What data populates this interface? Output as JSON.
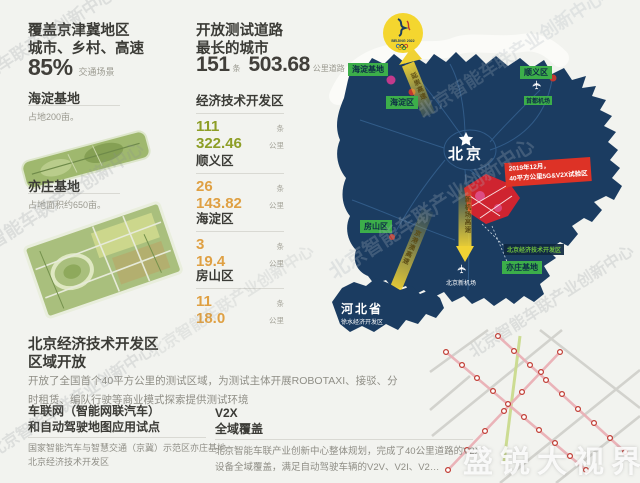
{
  "colors": {
    "accent_green": "#8d9e26",
    "accent_amber": "#dfa043",
    "label_green": "#3cae4a",
    "map_navy": "#1b3c61",
    "callout_red": "#dd3226",
    "arrow_yellow": "#f0d234"
  },
  "watermarks": {
    "diagonal": "北京智能车联产业创新中心",
    "video": "盛锐大视界"
  },
  "coverage": {
    "title_line1": "覆盖京津冀地区",
    "title_line2": "城市、乡村、高速",
    "percent": "85%",
    "percent_label": "交通场景"
  },
  "haidian_base": {
    "title": "海淀基地",
    "desc": "占地200亩。"
  },
  "yizhuang_base": {
    "title": "亦庄基地",
    "desc": "占地面积约650亩。"
  },
  "etdz_section": {
    "title_line1": "北京经济技术开发区",
    "title_line2": "区域开放",
    "desc": "开放了全国首个40平方公里的测试区域，为测试主体开展ROBOTAXI、接驳、分时租赁、编队行驶等商业模式探索提供测试环境"
  },
  "iov_section": {
    "title_line1": "车联网（智能网联汽车）",
    "title_line2": "和自动驾驶地图应用试点",
    "desc_line1": "国家智能汽车与智慧交通（京冀）示范区亦庄基地",
    "desc_line2": "北京经济技术开发区"
  },
  "v2x_section": {
    "title_line1": "V2X",
    "title_line2": "全域覆盖",
    "desc": "北京智能车联产业创新中心整体规划，完成了40公里道路的V2X设备全域覆盖，满足自动驾驶车辆的V2V、V2I、V2…"
  },
  "stats": {
    "header_line1": "开放测试道路",
    "header_line2": "最长的城市",
    "total_roads": "151",
    "total_roads_unit": "条",
    "total_km": "503.68",
    "total_km_unit": "公里道路",
    "unit_roads": "条",
    "unit_km": "公里",
    "districts": [
      {
        "name": "经济技术开发区",
        "roads": "111",
        "km": "322.46"
      },
      {
        "name": "顺义区",
        "roads": "26",
        "km": "143.82"
      },
      {
        "name": "海淀区",
        "roads": "3",
        "km": "19.4"
      },
      {
        "name": "房山区",
        "roads": "11",
        "km": "18.0"
      }
    ]
  },
  "map": {
    "beijing": "北京",
    "haidian_base": "海淀基地",
    "haidian_district": "海淀区",
    "shunyi_district": "顺义区",
    "fangshan_district": "房山区",
    "capital_airport": "首都机场",
    "new_airport": "北京新机场",
    "etdz_label": "北京经济技术开发区",
    "yizhuang_base": "亦庄基地",
    "hebei": "河北省",
    "hebei_sub": "徐水经济开发区",
    "callout_line1": "2019年12月，",
    "callout_line2": "40平方公里5G&V2X试验区",
    "arrow_olympic": "延崇高速",
    "arrow_new_airport": "新机场高速",
    "arrow_hebei": "京港澳高速",
    "olympic_text": "BEIJING 2022"
  }
}
